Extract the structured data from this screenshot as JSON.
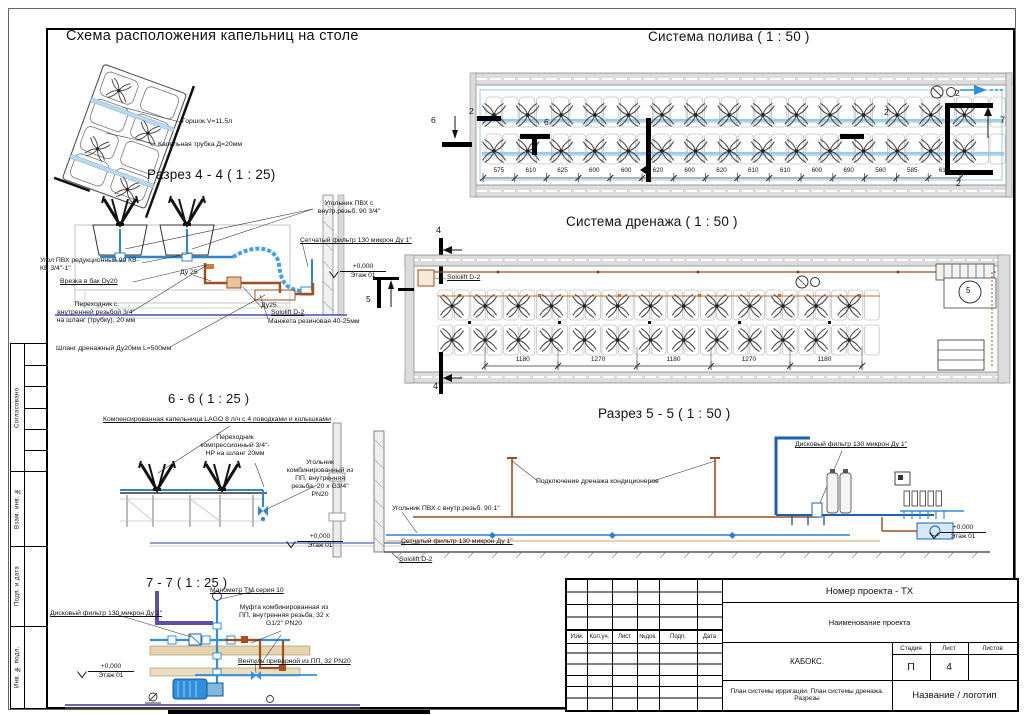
{
  "mk": {
    "n2": "2",
    "n4": "4",
    "n5": "5",
    "n6": "6",
    "n7": "7"
  },
  "elev": {
    "value": "+0,000",
    "floor": "Этаж 01"
  },
  "strip": {
    "items": [
      "Согласовано",
      "Взам. инв. №",
      "Подп. и дата",
      "Инв. № подл."
    ]
  },
  "scheme": {
    "title": "Схема расположения капельниц на столе",
    "pot": "Горшок V=11.5л",
    "tube": "Капельная трубка Д=20мм"
  },
  "irr": {
    "title": "Система полива ( 1 : 50 )",
    "dims": [
      "575",
      "610",
      "625",
      "600",
      "600",
      "620",
      "600",
      "620",
      "610",
      "610",
      "600",
      "690",
      "560",
      "585",
      "615"
    ]
  },
  "drain": {
    "title": "Система дренажа ( 1 : 50 )",
    "dims": [
      "1180",
      "1270",
      "1180",
      "1270",
      "1180"
    ],
    "sololift": "Sololift D-2"
  },
  "s44": {
    "title": "Разрез 4 - 4 ( 1 : 25)",
    "ugolnik_pvh": "Угольник ПВХ с внутр.резьб. 90 3/4\"",
    "filter_setch": "Сетчатый фильтр 130 микрон Ду 1\"",
    "ugol_reduk": "Угол ПВХ редукционный 90 КВ-КВ 3/4\"-1\"",
    "vrezka": "Врезка в бак Dy20",
    "du25a": "Ду 25",
    "du25b": "Ду25",
    "perehodnik": "Переходник с внутренней резьбой 3/4\" на шланг (трубку), 20 мм",
    "shlang": "Шланг дренажный  Ду20мм L=500мм",
    "sololift": "Sololift D-2",
    "manzheta": "Манжета резиновая 40-25мм"
  },
  "s66": {
    "title": "6 - 6 ( 1 : 25 )",
    "kapelnitsa": "Компенсированная капельница LAGO 8 л/ч с 4 поводками и колышками",
    "perehodnik": "Переходник компрессионный 3/4\"-НР на шланг 20мм",
    "ugolnik": "Угольник комбинированный из ПП, внутренняя резьба, 20 х G3/4\" PN20"
  },
  "s55": {
    "title": "Разрез 5 - 5 ( 1 : 50 )",
    "disk": "Дисковый фильтр 130 микрон Ду 1\"",
    "cond": "Подключение дренажа кондиционеров",
    "ugolnik": "Угольник ПВХ с внутр.резьб. 90 1\"",
    "setch": "Сетчатый фильтр 130 микрон Ду 1\"",
    "sololift": "Sololift D-2"
  },
  "s77": {
    "title": "7 - 7 ( 1 : 25 )",
    "manometr": "Манометр ТМ серия 10",
    "disk": "Дисковый фильтр 130 микрон Ду 1\"",
    "mufta": "Муфта комбинированная из ПП, внутренняя резьба, 32 х G1/2\" PN20",
    "ventil": "Вентиль приварной из ПП, 32 PN20"
  },
  "tb": {
    "project_number": "Номер проекта - ТХ",
    "project_name": "Наименование проекта",
    "company": "КАБОКС.",
    "stage_label": "Стадия",
    "sheet_label": "Лист",
    "sheets_label": "Листов",
    "stage": "П",
    "sheet_num": "4",
    "sheets": "",
    "doc_title": "План системы ирригации. План системы дренажа. Разрезы",
    "logo": "Название / логотип",
    "rev": [
      "Изм.",
      "Кол.уч.",
      "Лист",
      "№док.",
      "Подп.",
      "Дата"
    ]
  },
  "colors": {
    "pipe_blue": "#2e86c8",
    "light_blue": "#9cc9e6",
    "drain_brown": "#9c4f22",
    "floor_violet": "#5b4fa8"
  }
}
